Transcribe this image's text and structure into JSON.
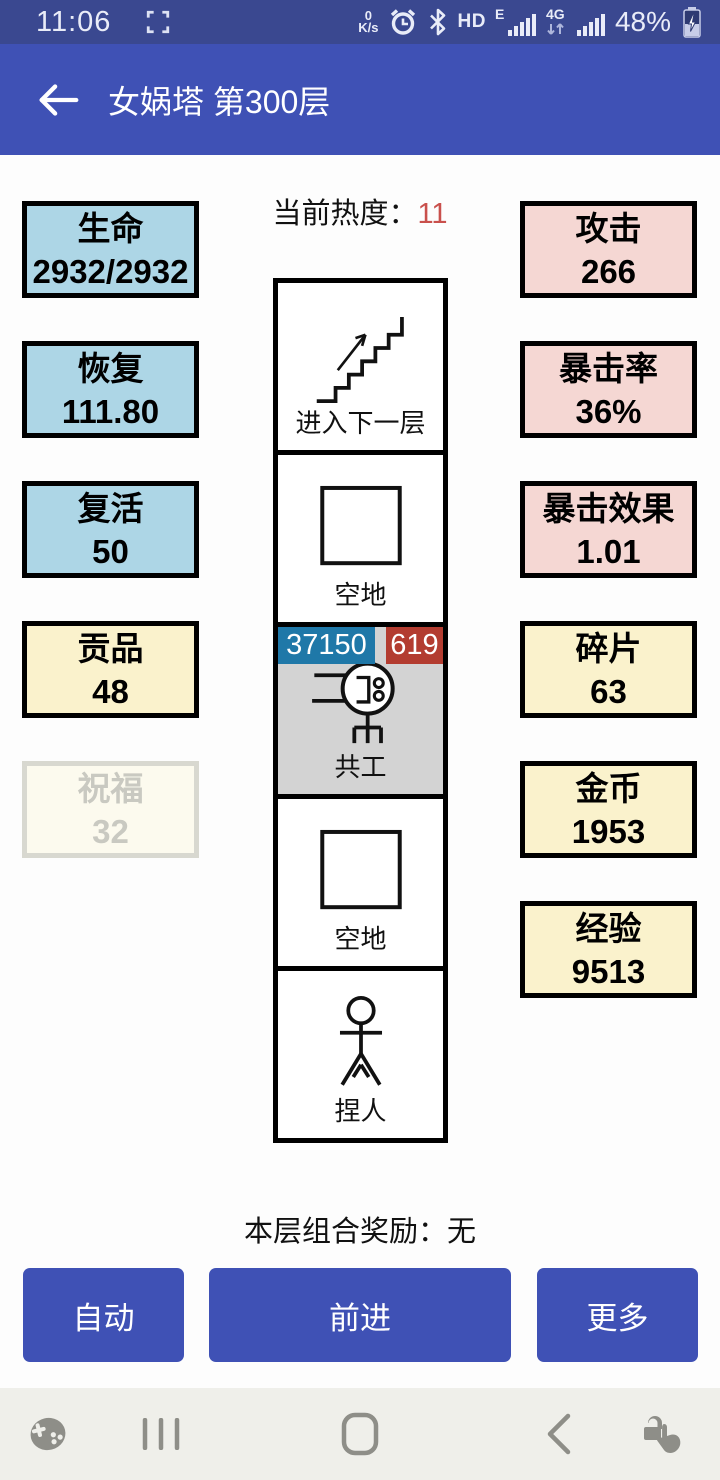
{
  "status_bar": {
    "time": "11:06",
    "network_speed_value": "0",
    "network_speed_unit": "K/s",
    "hd_label": "HD",
    "sim1_type": "E",
    "sim2_type": "4G",
    "battery_percent": "48%"
  },
  "app_bar": {
    "title": "女娲塔 第300层"
  },
  "heat": {
    "label": "当前热度：",
    "value": "11"
  },
  "stats_left": [
    {
      "label": "生命",
      "value": "2932/2932",
      "type": "blue"
    },
    {
      "label": "恢复",
      "value": "111.80",
      "type": "blue"
    },
    {
      "label": "复活",
      "value": "50",
      "type": "blue"
    },
    {
      "label": "贡品",
      "value": "48",
      "type": "yellow"
    },
    {
      "label": "祝福",
      "value": "32",
      "type": "disabled"
    }
  ],
  "stats_right": [
    {
      "label": "攻击",
      "value": "266",
      "type": "pink"
    },
    {
      "label": "暴击率",
      "value": "36%",
      "type": "pink"
    },
    {
      "label": "暴击效果",
      "value": "1.01",
      "type": "pink"
    },
    {
      "label": "碎片",
      "value": "63",
      "type": "yellow"
    },
    {
      "label": "金币",
      "value": "1953",
      "type": "yellow"
    },
    {
      "label": "经验",
      "value": "9513",
      "type": "yellow"
    }
  ],
  "map_cells": [
    {
      "label": "进入下一层",
      "icon": "stairs-up-icon",
      "type": "normal"
    },
    {
      "label": "空地",
      "icon": "empty-square-icon",
      "type": "normal"
    },
    {
      "label": "共工",
      "icon": "monster-icon",
      "type": "monster",
      "hp": "37150",
      "atk": "619"
    },
    {
      "label": "空地",
      "icon": "empty-square-icon",
      "type": "normal"
    },
    {
      "label": "捏人",
      "icon": "stick-figure-icon",
      "type": "normal"
    }
  ],
  "combo": {
    "text": "本层组合奖励：无"
  },
  "buttons": {
    "auto": "自动",
    "forward": "前进",
    "more": "更多"
  },
  "nav_bar": {
    "icons": [
      "game-launcher-icon",
      "recents-icon",
      "home-icon",
      "back-icon",
      "touch-lock-icon"
    ]
  },
  "colors": {
    "status_bar_bg": "#3A4890",
    "app_bar_bg": "#3F51B5",
    "stat_blue": "#ADD6E6",
    "stat_pink": "#F5D7D3",
    "stat_yellow": "#FAF2CC",
    "monster_cell_bg": "#D3D3D3",
    "hp_badge": "#1F78A8",
    "atk_badge": "#B33C30",
    "heat_value": "#C9504C",
    "button_bg": "#3F51B5",
    "nav_bar_bg": "#EFEFEA",
    "nav_icon": "#8E8E88"
  }
}
